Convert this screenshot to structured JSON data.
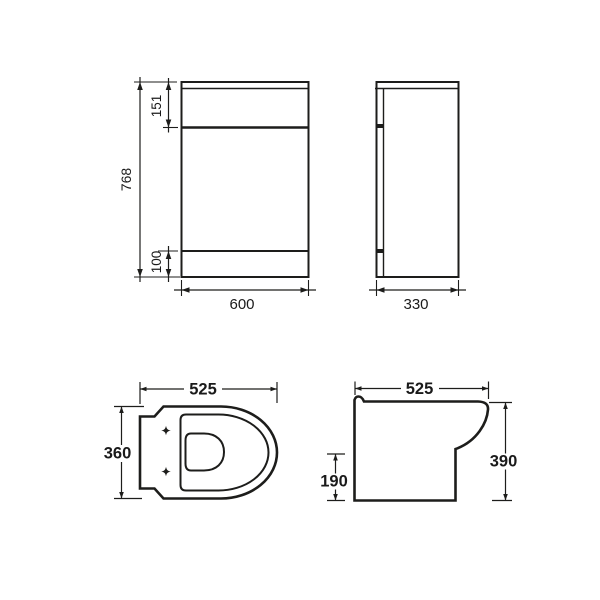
{
  "drawing_title": "WC vanity unit and back-to-wall pan dimension drawing",
  "colors": {
    "line": "#1d1d1b",
    "text": "#1a1a1a",
    "background": "#ffffff"
  },
  "unit_front": {
    "height": "768",
    "top_section_height": "151",
    "plinth_height": "100",
    "width": "600"
  },
  "unit_side": {
    "depth": "330"
  },
  "pan_top": {
    "width": "525",
    "depth": "360"
  },
  "pan_side": {
    "width": "525",
    "height": "390",
    "rear_step_height": "190"
  }
}
